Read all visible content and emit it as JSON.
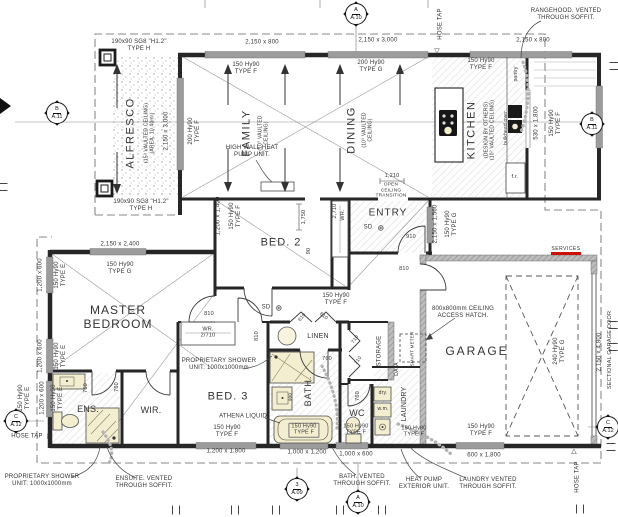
{
  "title": "Floor plan drawing",
  "colors": {
    "wall": "#262626",
    "window_grey": "#9c9c9c",
    "hatch": "#d8d8d8",
    "fixture_cream": "#f3eecf",
    "services_red": "#cc1100",
    "dashed_boundary": "#8a8a8a",
    "text": "#333333"
  },
  "labels": [
    {
      "t": "190x90 SG8 \"H1.2\"\nTYPE H",
      "x": 139,
      "y": 46,
      "s": 6
    },
    {
      "t": "2,150 x 800",
      "x": 262,
      "y": 43,
      "s": 6
    },
    {
      "t": "2,150 x 3,000",
      "x": 378,
      "y": 41,
      "s": 6
    },
    {
      "t": "2,150 x 800",
      "x": 533,
      "y": 41,
      "s": 6
    },
    {
      "t": "150 Hy90\nTYPE F",
      "x": 246,
      "y": 69,
      "s": 6
    },
    {
      "t": "200 Hy90\nTYPE G",
      "x": 371,
      "y": 67,
      "s": 6
    },
    {
      "t": "150 Hy90\nTYPE F",
      "x": 481,
      "y": 65,
      "s": 6
    },
    {
      "t": "HOSE TAP",
      "x": 441,
      "y": 24,
      "r": -90,
      "s": 6
    },
    {
      "t": "▽",
      "x": 437,
      "y": 52,
      "s": 7
    },
    {
      "t": "RANGEHOOD. VENTED\nTHROUGH SOFFIT.",
      "x": 566,
      "y": 15,
      "s": 6
    },
    {
      "n": "room-label-alfresco",
      "t": "ALFRESCO",
      "x": 131,
      "y": 133,
      "r": -90,
      "s": 11,
      "ls": 1.5
    },
    {
      "t": "(15° VAULTED CEILING)\n(AREA: 10.40m²)",
      "x": 150,
      "y": 133,
      "r": -90,
      "s": 5
    },
    {
      "t": "2,150 x 3,000",
      "x": 167,
      "y": 131,
      "r": -90,
      "s": 6
    },
    {
      "t": "200 Hy90\nTYPE F",
      "x": 195,
      "y": 131,
      "r": -90,
      "s": 6
    },
    {
      "t": "190x90 SG8 \"H1.2\"\nTYPE H",
      "x": 141,
      "y": 206,
      "s": 6
    },
    {
      "n": "room-label-family",
      "t": "FAMILY",
      "x": 247,
      "y": 133,
      "r": -90,
      "s": 11,
      "ls": 1.5
    },
    {
      "t": "(10° VAULTED\nCEILING)",
      "x": 264,
      "y": 133,
      "r": -90,
      "s": 5
    },
    {
      "t": "HIGH WALL HEAT\nPUMP UNIT.",
      "x": 252,
      "y": 152,
      "s": 6
    },
    {
      "n": "room-label-dining",
      "t": "DINING",
      "x": 352,
      "y": 130,
      "r": -90,
      "s": 11,
      "ls": 1.5
    },
    {
      "t": "(10° VAULTED\nCEILING)",
      "x": 368,
      "y": 130,
      "r": -90,
      "s": 5
    },
    {
      "n": "room-label-kitchen",
      "t": "KITCHEN",
      "x": 472,
      "y": 130,
      "r": -90,
      "s": 11,
      "ls": 1.5
    },
    {
      "t": "(DESIGN BY OTHERS)\n(10° VAULTED CEILING)",
      "x": 490,
      "y": 130,
      "r": -90,
      "s": 5
    },
    {
      "t": "pantry",
      "x": 517,
      "y": 74,
      "r": -90,
      "s": 5
    },
    {
      "t": "bulkhead over",
      "x": 507,
      "y": 128,
      "r": -90,
      "s": 5
    },
    {
      "t": "f.r.",
      "x": 515,
      "y": 177,
      "s": 5.5
    },
    {
      "t": "530 x 1,800",
      "x": 537,
      "y": 123,
      "r": -90,
      "s": 6
    },
    {
      "t": "150 Hy90\nTYPE F",
      "x": 556,
      "y": 123,
      "r": -90,
      "s": 6
    },
    {
      "t": "1,210",
      "x": 392,
      "y": 176,
      "s": 5.5
    },
    {
      "t": "OPEN\nCEILING\nTRANSITION",
      "x": 391,
      "y": 191,
      "s": 4.8
    },
    {
      "n": "room-label-entry",
      "t": "ENTRY",
      "x": 388,
      "y": 213,
      "s": 10,
      "ls": 1
    },
    {
      "t": "SD",
      "x": 368,
      "y": 228,
      "s": 6
    },
    {
      "t": "⊛",
      "x": 381,
      "y": 228,
      "s": 8
    },
    {
      "t": "910",
      "x": 411,
      "y": 237,
      "s": 5.5
    },
    {
      "t": "2,150 x 1,560",
      "x": 436,
      "y": 224,
      "r": -90,
      "s": 6
    },
    {
      "t": "150 Hy90\nTYPE G",
      "x": 452,
      "y": 224,
      "r": -90,
      "s": 6
    },
    {
      "t": "2,710",
      "x": 335,
      "y": 211,
      "r": -90,
      "s": 5.5
    },
    {
      "t": "WR.",
      "x": 343,
      "y": 215,
      "r": -90,
      "s": 5.5
    },
    {
      "n": "room-label-bed2",
      "t": "BED. 2",
      "x": 281,
      "y": 243,
      "s": 11,
      "ls": 1
    },
    {
      "t": "1,200 x 1,400",
      "x": 219,
      "y": 216,
      "r": -90,
      "s": 6
    },
    {
      "t": "150 Hy90\nTYPE F",
      "x": 236,
      "y": 216,
      "r": -90,
      "s": 6
    },
    {
      "t": "1,750",
      "x": 304,
      "y": 217,
      "r": -90,
      "s": 5.5
    },
    {
      "t": "90",
      "x": 309,
      "y": 251,
      "r": -90,
      "s": 5.5
    },
    {
      "t": "810",
      "x": 404,
      "y": 269,
      "s": 5.5
    },
    {
      "t": "800x800mm CEILING\nACCESS HATCH.",
      "x": 463,
      "y": 313,
      "s": 6
    },
    {
      "t": "SERVICES",
      "x": 566,
      "y": 250,
      "s": 5,
      "ls": 0.5
    },
    {
      "n": "room-label-garage",
      "t": "GARAGE",
      "x": 477,
      "y": 352,
      "s": 12,
      "ls": 2
    },
    {
      "t": "240 Hy90\nTYPE G",
      "x": 560,
      "y": 351,
      "r": -90,
      "s": 6
    },
    {
      "t": "2,150 x 4,800",
      "x": 600,
      "y": 352,
      "r": -90,
      "s": 6
    },
    {
      "t": "SECTIONAL GARAGE DOOR",
      "x": 610,
      "y": 350,
      "r": -90,
      "s": 5.5
    },
    {
      "n": "room-label-master-bedroom",
      "t": "MASTER\nBEDROOM",
      "x": 118,
      "y": 318,
      "s": 12,
      "ls": 1
    },
    {
      "t": "2,150 x 2,400",
      "x": 120,
      "y": 245,
      "s": 6
    },
    {
      "t": "150 Hy90\nTYPE G",
      "x": 120,
      "y": 269,
      "s": 6
    },
    {
      "t": "1,200 x 600",
      "x": 41,
      "y": 275,
      "r": -90,
      "s": 6
    },
    {
      "t": "150 Hy90\nTYPE E",
      "x": 61,
      "y": 275,
      "r": -90,
      "s": 6
    },
    {
      "t": "1,200 x 600",
      "x": 41,
      "y": 356,
      "r": -90,
      "s": 6
    },
    {
      "t": "150 Hy90\nTYPE E",
      "x": 61,
      "y": 356,
      "r": -90,
      "s": 6
    },
    {
      "t": "150 Hy90\nTYPE E",
      "x": 25,
      "y": 398,
      "r": -90,
      "s": 6
    },
    {
      "t": "1,200 x 600",
      "x": 43,
      "y": 398,
      "r": -90,
      "s": 6
    },
    {
      "t": "150 Hy90\nTYPE E",
      "x": 58,
      "y": 398,
      "r": -90,
      "s": 6
    },
    {
      "t": "SD",
      "x": 266,
      "y": 308,
      "s": 6
    },
    {
      "t": "⊛",
      "x": 279,
      "y": 308,
      "s": 8
    },
    {
      "t": "150 Hy90\nTYPE F",
      "x": 336,
      "y": 300,
      "s": 6
    },
    {
      "t": "810",
      "x": 209,
      "y": 314,
      "s": 5.5
    },
    {
      "t": "810",
      "x": 257,
      "y": 336,
      "r": -90,
      "s": 5.5
    },
    {
      "t": "WR.\n2/710",
      "x": 208,
      "y": 333,
      "s": 5.5
    },
    {
      "n": "room-label-linen",
      "t": "LINEN",
      "x": 318,
      "y": 337,
      "s": 7
    },
    {
      "t": "610",
      "x": 303,
      "y": 318,
      "r": -50,
      "s": 5
    },
    {
      "t": "610",
      "x": 323,
      "y": 317,
      "r": 40,
      "s": 5
    },
    {
      "t": "760",
      "x": 327,
      "y": 359,
      "s": 5.5
    },
    {
      "t": "PROPRIETARY SHOWER\nUNIT: 1000x1000mm",
      "x": 219,
      "y": 365,
      "s": 6
    },
    {
      "n": "room-label-bed3",
      "t": "BED. 3",
      "x": 228,
      "y": 397,
      "s": 11,
      "ls": 1
    },
    {
      "t": "ATHENA LIQUID",
      "x": 243,
      "y": 417,
      "s": 6
    },
    {
      "t": "150 Hy90\nTYPE F",
      "x": 227,
      "y": 432,
      "s": 6
    },
    {
      "t": "150 Hy90\nTYPE F",
      "x": 304,
      "y": 430,
      "s": 5.5,
      "bg": 1
    },
    {
      "t": "1,200 x 1,800",
      "x": 226,
      "y": 452,
      "s": 6
    },
    {
      "t": "1,000 x 1,200",
      "x": 307,
      "y": 453,
      "s": 6
    },
    {
      "t": "1,000 x 600",
      "x": 356,
      "y": 455,
      "s": 6
    },
    {
      "n": "room-label-bath",
      "t": "BATH.",
      "x": 308,
      "y": 391,
      "r": -90,
      "s": 9,
      "ls": 1
    },
    {
      "t": "900",
      "x": 290,
      "y": 397,
      "r": -90,
      "s": 4.5
    },
    {
      "n": "room-label-wc",
      "t": "WC",
      "x": 357,
      "y": 413,
      "s": 9
    },
    {
      "t": "150 Hy90\nTYPE F",
      "x": 356,
      "y": 430,
      "s": 5.5
    },
    {
      "t": "760",
      "x": 358,
      "y": 396,
      "r": -90,
      "s": 5.5
    },
    {
      "t": "710",
      "x": 356,
      "y": 340,
      "r": -55,
      "s": 5
    },
    {
      "t": "710",
      "x": 359,
      "y": 361,
      "r": -55,
      "s": 5
    },
    {
      "n": "room-label-storage",
      "t": "STORAGE",
      "x": 380,
      "y": 351,
      "r": -90,
      "s": 6
    },
    {
      "t": "DATA",
      "x": 398,
      "y": 369,
      "r": -90,
      "s": 5
    },
    {
      "t": "SMART METER",
      "x": 412,
      "y": 349,
      "r": -90,
      "s": 4.5
    },
    {
      "n": "room-label-laundry",
      "t": "LAUNDRY",
      "x": 405,
      "y": 404,
      "r": -90,
      "s": 7
    },
    {
      "t": "dry.",
      "x": 383,
      "y": 394,
      "s": 5
    },
    {
      "t": "w.m.",
      "x": 383,
      "y": 410,
      "s": 5
    },
    {
      "t": "150 Hy90\nTYPE F",
      "x": 414,
      "y": 432,
      "s": 5.5
    },
    {
      "n": "room-label-wir",
      "t": "WIR.",
      "x": 151,
      "y": 410,
      "s": 9
    },
    {
      "n": "room-label-ens",
      "t": "ENS.",
      "x": 88,
      "y": 409,
      "s": 9
    },
    {
      "t": "760",
      "x": 86,
      "y": 388,
      "r": -90,
      "s": 5.5
    },
    {
      "t": "760",
      "x": 117,
      "y": 387,
      "r": -90,
      "s": 5.5
    },
    {
      "t": "HOSE TAP",
      "x": 27,
      "y": 437,
      "s": 6
    },
    {
      "t": "▷",
      "x": 50,
      "y": 437,
      "s": 7
    },
    {
      "t": "150 Hy90\nTYPE F",
      "x": 481,
      "y": 431,
      "s": 6
    },
    {
      "t": "600 x 1,800",
      "x": 484,
      "y": 456,
      "s": 6
    },
    {
      "t": "HOSE TAP",
      "x": 578,
      "y": 477,
      "r": -90,
      "s": 6
    },
    {
      "t": "△",
      "x": 574,
      "y": 452,
      "s": 7
    },
    {
      "t": "PROPRIETARY SHOWER\nUNIT: 1000x1000mm",
      "x": 42,
      "y": 481,
      "s": 6
    },
    {
      "t": "ENSUITE. VENTED\nTHROUGH SOFFIT.",
      "x": 144,
      "y": 483,
      "s": 6
    },
    {
      "t": "BATH. VENTED\nTHROUGH SOFFIT.",
      "x": 362,
      "y": 481,
      "s": 6
    },
    {
      "t": "HEAT PUMP\nEXTERIOR UNIT.",
      "x": 424,
      "y": 484,
      "s": 6
    },
    {
      "t": "LAUNDRY VENTED\nTHROUGH SOFFIT.",
      "x": 488,
      "y": 484,
      "s": 6
    }
  ],
  "markers": [
    {
      "t": "A",
      "b": "A.10",
      "x": 356,
      "y": 14
    },
    {
      "t": "B",
      "b": "A.11",
      "x": 57,
      "y": 113
    },
    {
      "t": "B",
      "b": "A.11",
      "x": 592,
      "y": 124
    },
    {
      "t": "C",
      "b": "A.12",
      "x": 16,
      "y": 421
    },
    {
      "t": "C",
      "b": "A.12",
      "x": 608,
      "y": 427
    },
    {
      "t": "3",
      "b": "A.09",
      "x": 297,
      "y": 489
    },
    {
      "t": "A",
      "b": "A.10",
      "x": 358,
      "y": 502
    }
  ],
  "ticks": [
    {
      "x": 3,
      "y": 187,
      "r": 90
    },
    {
      "x": 614,
      "y": 66,
      "r": 90
    },
    {
      "x": 613,
      "y": 325,
      "r": 90
    },
    {
      "x": 613,
      "y": 347,
      "r": 90
    },
    {
      "x": 611,
      "y": 447,
      "r": 90
    },
    {
      "x": 176,
      "y": 510,
      "r": 0
    },
    {
      "x": 235,
      "y": 510,
      "r": 0
    },
    {
      "x": 276,
      "y": 510,
      "r": 0
    },
    {
      "x": 340,
      "y": 510,
      "r": 0
    },
    {
      "x": 382,
      "y": 510,
      "r": 0
    },
    {
      "x": 580,
      "y": 509,
      "r": 0
    }
  ]
}
